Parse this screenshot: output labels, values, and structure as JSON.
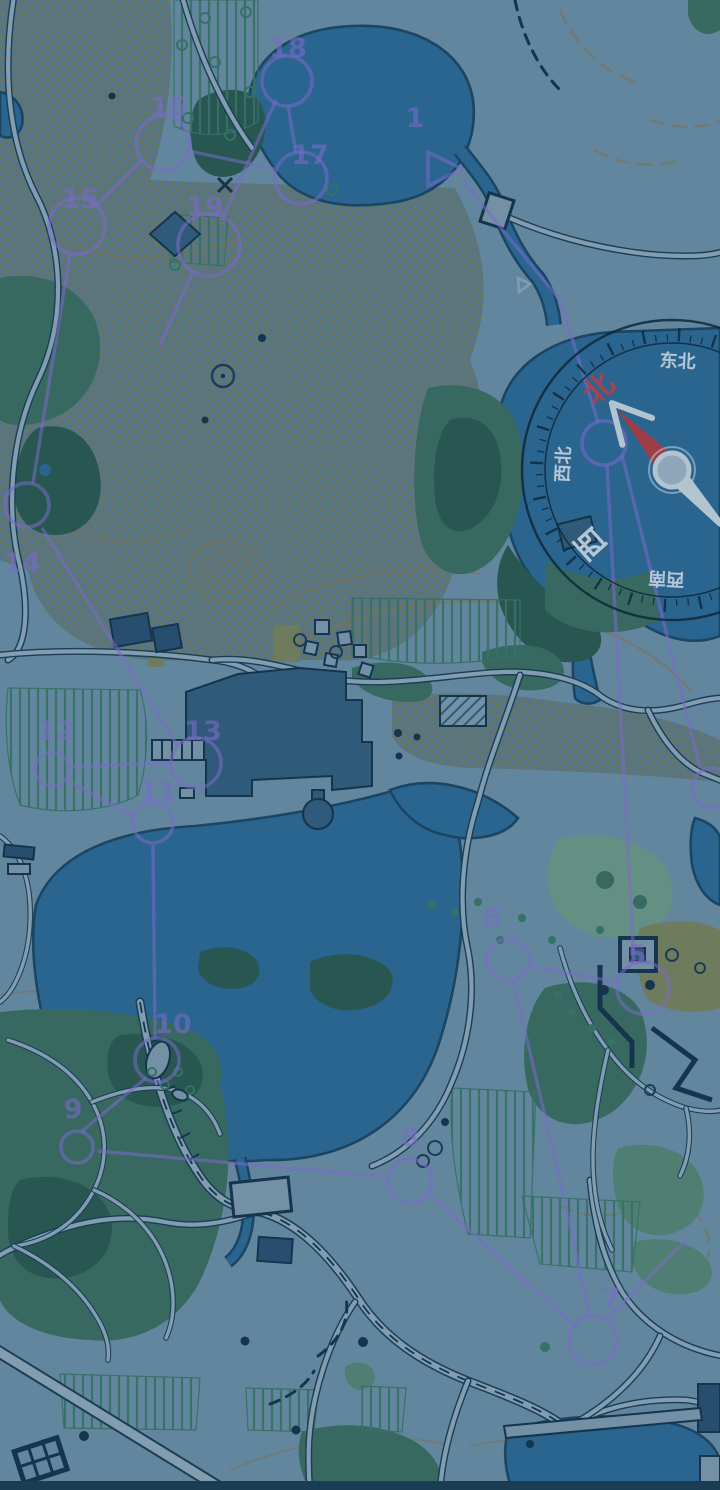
{
  "scene": {
    "type": "orienteering-park-map",
    "description": "Park orienteering map screenshot dimmed with a dark blue overlay; rotated compass rose with Chinese cardinal labels and a purple numbered course route",
    "width": 720,
    "height": 1490
  },
  "palette": {
    "base": "#6d91a7",
    "roadFill": "#8fabbc",
    "roadCasing": "#1c4158",
    "water": "#2e6c99",
    "waterEdge": "#1d4967",
    "forestDark": "#2b5d52",
    "forestMid": "#3d7164",
    "forestTeal": "#578879",
    "forestPale": "#6f9c8c",
    "olive": "#7b8560",
    "dotBg": "#5d7e92",
    "dotFg": "#6f7e6e",
    "stripeGreen": "#3c7a6b",
    "building": "#35607f",
    "buildingDark": "#2b5274",
    "lightStruct": "#7f9cb0",
    "navy": "#16374f",
    "contour": "#8b7a58",
    "course": "#8673d8",
    "compassDark": "#0f2838",
    "needleRed": "#b23f44",
    "needleBody": "#c6d6e0",
    "pivotFill": "#9eb6c8",
    "labelWhite": "#d8e4ec",
    "labelRed": "#c8434a"
  },
  "compass": {
    "cx": 672,
    "cy": 470,
    "outer_radius": 150,
    "inner_radius": 127,
    "rotation_deg": -42,
    "labels": [
      {
        "text": "北",
        "bearing": 0,
        "size": 30,
        "color": "#c8434a",
        "name": "north"
      },
      {
        "text": "东北",
        "bearing": 45,
        "size": 18,
        "color": "#d8e4ec",
        "name": "northeast"
      },
      {
        "text": "西南",
        "bearing": 225,
        "size": 18,
        "color": "#d8e4ec",
        "name": "southwest"
      },
      {
        "text": "西",
        "bearing": 270,
        "size": 30,
        "color": "#d8e4ec",
        "name": "west"
      },
      {
        "text": "西北",
        "bearing": 315,
        "size": 18,
        "color": "#d8e4ec",
        "name": "northwest"
      }
    ]
  },
  "course": {
    "number_font_size": 27,
    "start": {
      "label": "1",
      "points": "428,152 428,186 462,169",
      "label_x": 415,
      "label_y": 127
    },
    "controls": [
      {
        "n": "",
        "cx": 604,
        "cy": 443,
        "r": 22
      },
      {
        "n": "5",
        "cx": 643,
        "cy": 988,
        "r": 26,
        "lx": 637,
        "ly": 955
      },
      {
        "n": "6",
        "cx": 508,
        "cy": 960,
        "r": 21,
        "lx": 492,
        "ly": 918
      },
      {
        "n": "7",
        "cx": 593,
        "cy": 1340,
        "r": 24,
        "lx": 611,
        "ly": 1298
      },
      {
        "n": "8",
        "cx": 410,
        "cy": 1181,
        "r": 22,
        "lx": 410,
        "ly": 1137
      },
      {
        "n": "9",
        "cx": 77,
        "cy": 1147,
        "r": 16,
        "lx": 73,
        "ly": 1109
      },
      {
        "n": "10",
        "cx": 157,
        "cy": 1060,
        "r": 22,
        "lx": 173,
        "ly": 1024
      },
      {
        "n": "11",
        "cx": 153,
        "cy": 823,
        "r": 20,
        "lx": 158,
        "ly": 792
      },
      {
        "n": "12",
        "cx": 52,
        "cy": 769,
        "r": 17,
        "lx": 55,
        "ly": 731
      },
      {
        "n": "13",
        "cx": 196,
        "cy": 763,
        "r": 25,
        "lx": 203,
        "ly": 731
      },
      {
        "n": "14",
        "cx": 27,
        "cy": 505,
        "r": 22,
        "lx": 22,
        "ly": 563
      },
      {
        "n": "15",
        "cx": 77,
        "cy": 226,
        "r": 28,
        "lx": 80,
        "ly": 199
      },
      {
        "n": "16",
        "cx": 163,
        "cy": 143,
        "r": 27,
        "lx": 169,
        "ly": 107
      },
      {
        "n": "17",
        "cx": 301,
        "cy": 178,
        "r": 26,
        "lx": 310,
        "ly": 155
      },
      {
        "n": "18",
        "cx": 287,
        "cy": 81,
        "r": 25,
        "lx": 288,
        "ly": 48
      },
      {
        "n": "19",
        "cx": 209,
        "cy": 245,
        "r": 31,
        "lx": 205,
        "ly": 207
      }
    ],
    "extra_circles": [
      {
        "cx": 712,
        "cy": 788,
        "r": 20
      }
    ],
    "legs": [
      [
        462,
        180,
        560,
        300
      ],
      [
        560,
        300,
        598,
        422
      ],
      [
        607,
        465,
        634,
        962
      ],
      [
        622,
        455,
        700,
        768
      ],
      [
        617,
        982,
        529,
        966
      ],
      [
        513,
        980,
        560,
        1180
      ],
      [
        560,
        1180,
        590,
        1317
      ],
      [
        577,
        1328,
        428,
        1193
      ],
      [
        608,
        1318,
        688,
        1238
      ],
      [
        388,
        1177,
        98,
        1151
      ],
      [
        82,
        1131,
        146,
        1078
      ],
      [
        155,
        1038,
        153,
        845
      ],
      [
        134,
        817,
        70,
        782
      ],
      [
        71,
        767,
        171,
        763
      ],
      [
        177,
        745,
        42,
        528
      ],
      [
        33,
        483,
        70,
        253
      ],
      [
        96,
        206,
        142,
        160
      ],
      [
        189,
        151,
        275,
        169
      ],
      [
        296,
        153,
        288,
        106
      ],
      [
        276,
        100,
        222,
        220
      ],
      [
        193,
        272,
        160,
        345
      ]
    ]
  }
}
